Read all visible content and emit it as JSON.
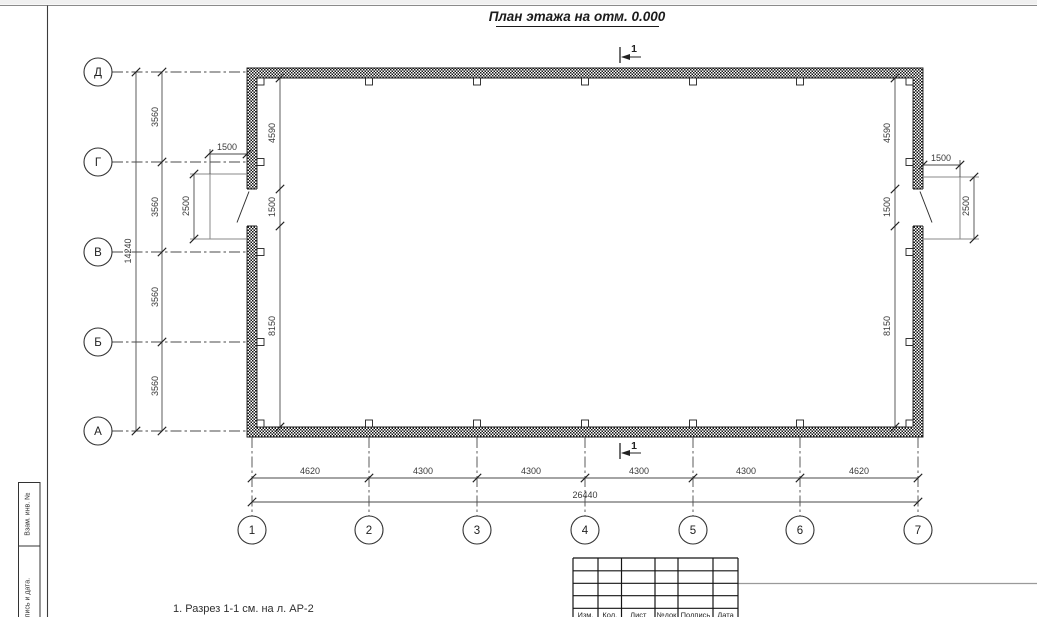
{
  "sheet": {
    "title": "План этажа на отм. 0.000",
    "note": "1. Разрез 1-1 см. на л. АР-2"
  },
  "section": {
    "label": "1"
  },
  "grid": {
    "rows": [
      "Д",
      "Г",
      "В",
      "Б",
      "А"
    ],
    "cols": [
      "1",
      "2",
      "3",
      "4",
      "5",
      "6",
      "7"
    ]
  },
  "dims": {
    "left_chain": [
      "3560",
      "3560",
      "3560",
      "3560"
    ],
    "left_total": "14240",
    "bottom_chain": [
      "4620",
      "4300",
      "4300",
      "4300",
      "4300",
      "4620"
    ],
    "bottom_total": "26440",
    "inner_left": [
      "4590",
      "1500",
      "8150"
    ],
    "inner_right": [
      "4590",
      "1500",
      "8150"
    ],
    "door_left": {
      "width": "1500",
      "swing": "2500"
    },
    "door_right": {
      "width": "1500",
      "swing": "2500"
    }
  },
  "titleblock": {
    "headers": [
      "Изм.",
      "Кол.",
      "Лист",
      "№док",
      "Подпись",
      "Дата"
    ]
  },
  "sidebar": {
    "stamps": [
      "Взам. инв. №",
      "Подпись и дата."
    ]
  },
  "colors": {
    "ink": "#1a1a1a",
    "dim_ink": "#4a4a4a",
    "muted": "#8a8a8a"
  }
}
